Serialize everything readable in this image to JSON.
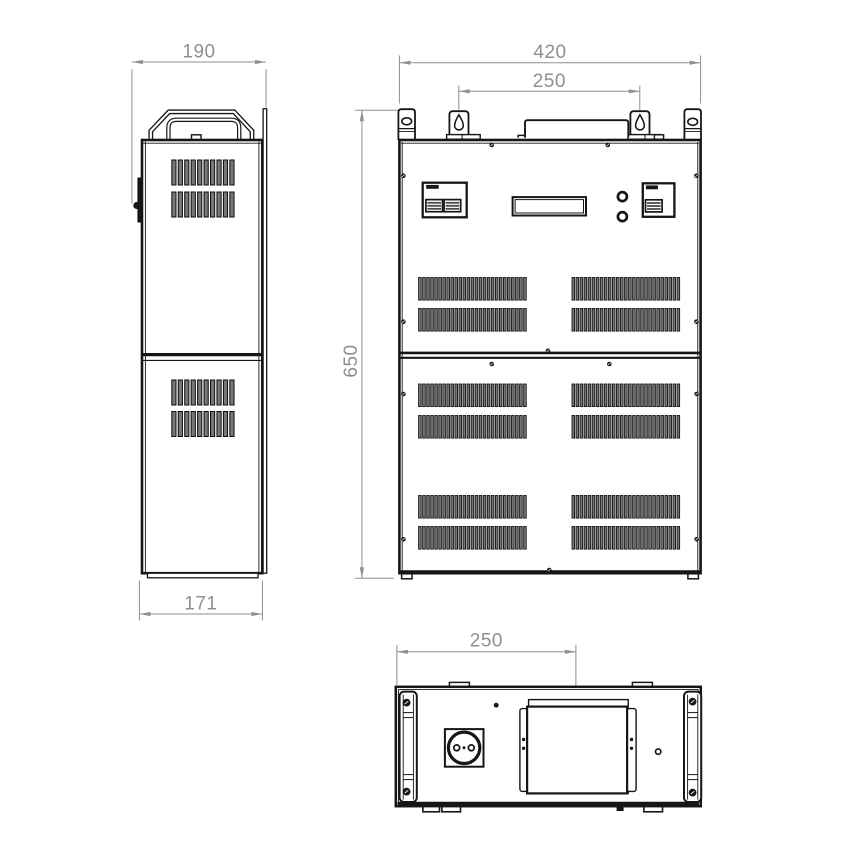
{
  "dimensions": {
    "side_depth": "190",
    "side_depth_bottom": "171",
    "front_width": "420",
    "front_mount_spacing": "250",
    "front_height": "650",
    "bottom_terminal_offset": "250"
  },
  "colors": {
    "background": "#ffffff",
    "line": "#161616",
    "dimension": "#8f8f8f",
    "vent_fill": "#777777"
  }
}
